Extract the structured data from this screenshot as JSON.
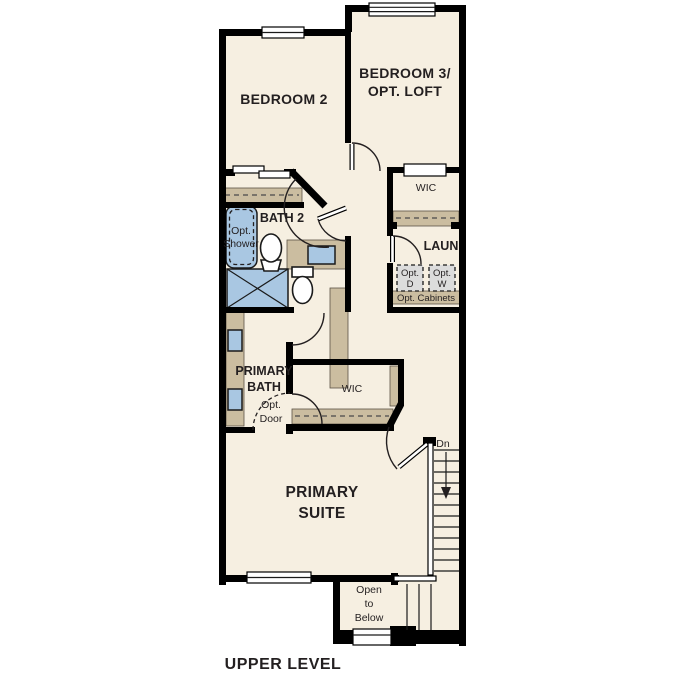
{
  "title": "UPPER LEVEL",
  "colors": {
    "floor": "#f6efe1",
    "wall": "#000000",
    "cabinet_tan": "#cbbda0",
    "fixture_blue": "#a9c7e2",
    "appliance_gray": "#dcdcdc",
    "text": "#231f20"
  },
  "rooms": {
    "bedroom_2": {
      "label": "BEDROOM 2"
    },
    "bedroom_3": {
      "label_line_1": "BEDROOM 3/",
      "label_line_2": "OPT. LOFT"
    },
    "wic_upper": {
      "label": "WIC"
    },
    "bath_2": {
      "label": "BATH 2"
    },
    "opt_shower": {
      "line_1": "Opt.",
      "line_2": "Shower"
    },
    "laundry": {
      "label": "LAUN",
      "opt_dryer_line_1": "Opt.",
      "opt_dryer_line_2": "D",
      "opt_washer_line_1": "Opt.",
      "opt_washer_line_2": "W",
      "opt_cabinets_label": "Opt. Cabinets"
    },
    "primary_bath": {
      "label_line_1": "PRIMARY",
      "label_line_2": "BATH",
      "opt_door_line_1": "Opt.",
      "opt_door_line_2": "Door"
    },
    "wic_primary": {
      "label": "WIC"
    },
    "primary_suite": {
      "label_line_1": "PRIMARY",
      "label_line_2": "SUITE"
    },
    "stairs": {
      "down_label": "Dn"
    },
    "open_to_below": {
      "line_1": "Open",
      "line_2": "to",
      "line_3": "Below"
    }
  }
}
